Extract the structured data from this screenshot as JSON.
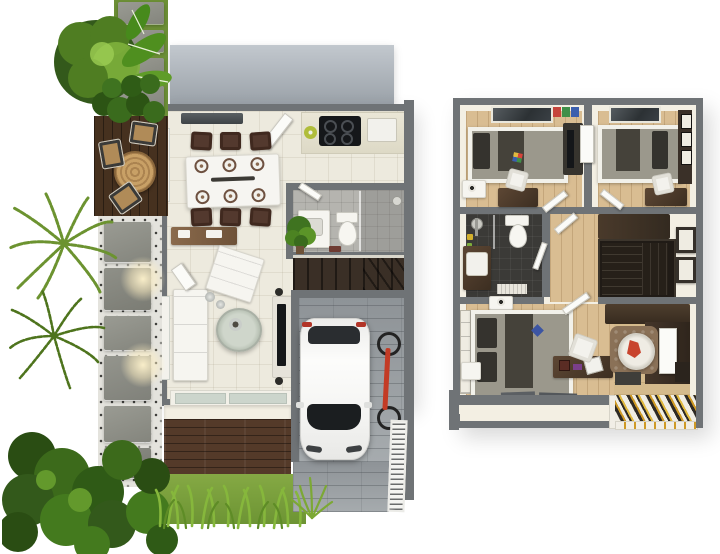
{
  "scene": {
    "kind": "3d-rendered-two-storey-floor-plan",
    "plans": [
      {
        "id": "ground-floor",
        "rooms": [
          "kitchen",
          "dining-area",
          "living-room",
          "bathroom",
          "staircase",
          "garage"
        ],
        "outdoor": [
          "roof-slab",
          "outdoor-deck",
          "stone-path",
          "entry-deck",
          "lawn",
          "driveway",
          "garden-trees",
          "gate"
        ]
      },
      {
        "id": "upper-floor",
        "rooms": [
          "bedroom-left",
          "bedroom-right",
          "bathroom",
          "hallway",
          "staircase",
          "master-bedroom",
          "sitting-nook"
        ],
        "outdoor": [
          "louvered-pergola"
        ]
      }
    ]
  },
  "palette": {
    "wall": "#6f7376",
    "wallFace": "#f3efe3",
    "roofLight": "#c2c8ce",
    "roofDark": "#9aa1a8",
    "tileFloor": "#edeade",
    "woodFloor": "#d9bd92",
    "woodFloorLight": "#d4ba8c",
    "bathDark": "#3b3a37",
    "bathGray": "#b5b4af",
    "pavers": "#a6abae",
    "paversDark": "#8e9397",
    "gravel": "#e4e3dd",
    "grass": "#76a23b",
    "treeDark": "#33591b",
    "treeMid": "#4f7d22",
    "treeLight": "#7eb13c",
    "stairDark": "#3a2f26",
    "stairUpper": "#262019",
    "whiteFurn": "#f6f5f0",
    "tv": "#141619",
    "carBody": "#fafaf8",
    "windowDark": "#3e4346",
    "bedStripeA": "#908d81",
    "bedStripeB": "#45423a",
    "pillowDark": "#35332e",
    "rug": "#8a7157",
    "accentRed": "#c8442e",
    "accentBlue": "#3c55a3",
    "pergolaWhite": "#f0ede3",
    "pergolaDarkStripe": "#2e2a25",
    "pergolaOrange": "#cf9a25",
    "gate": "#f4f4f1",
    "lampGlow": "#fff3cd"
  }
}
